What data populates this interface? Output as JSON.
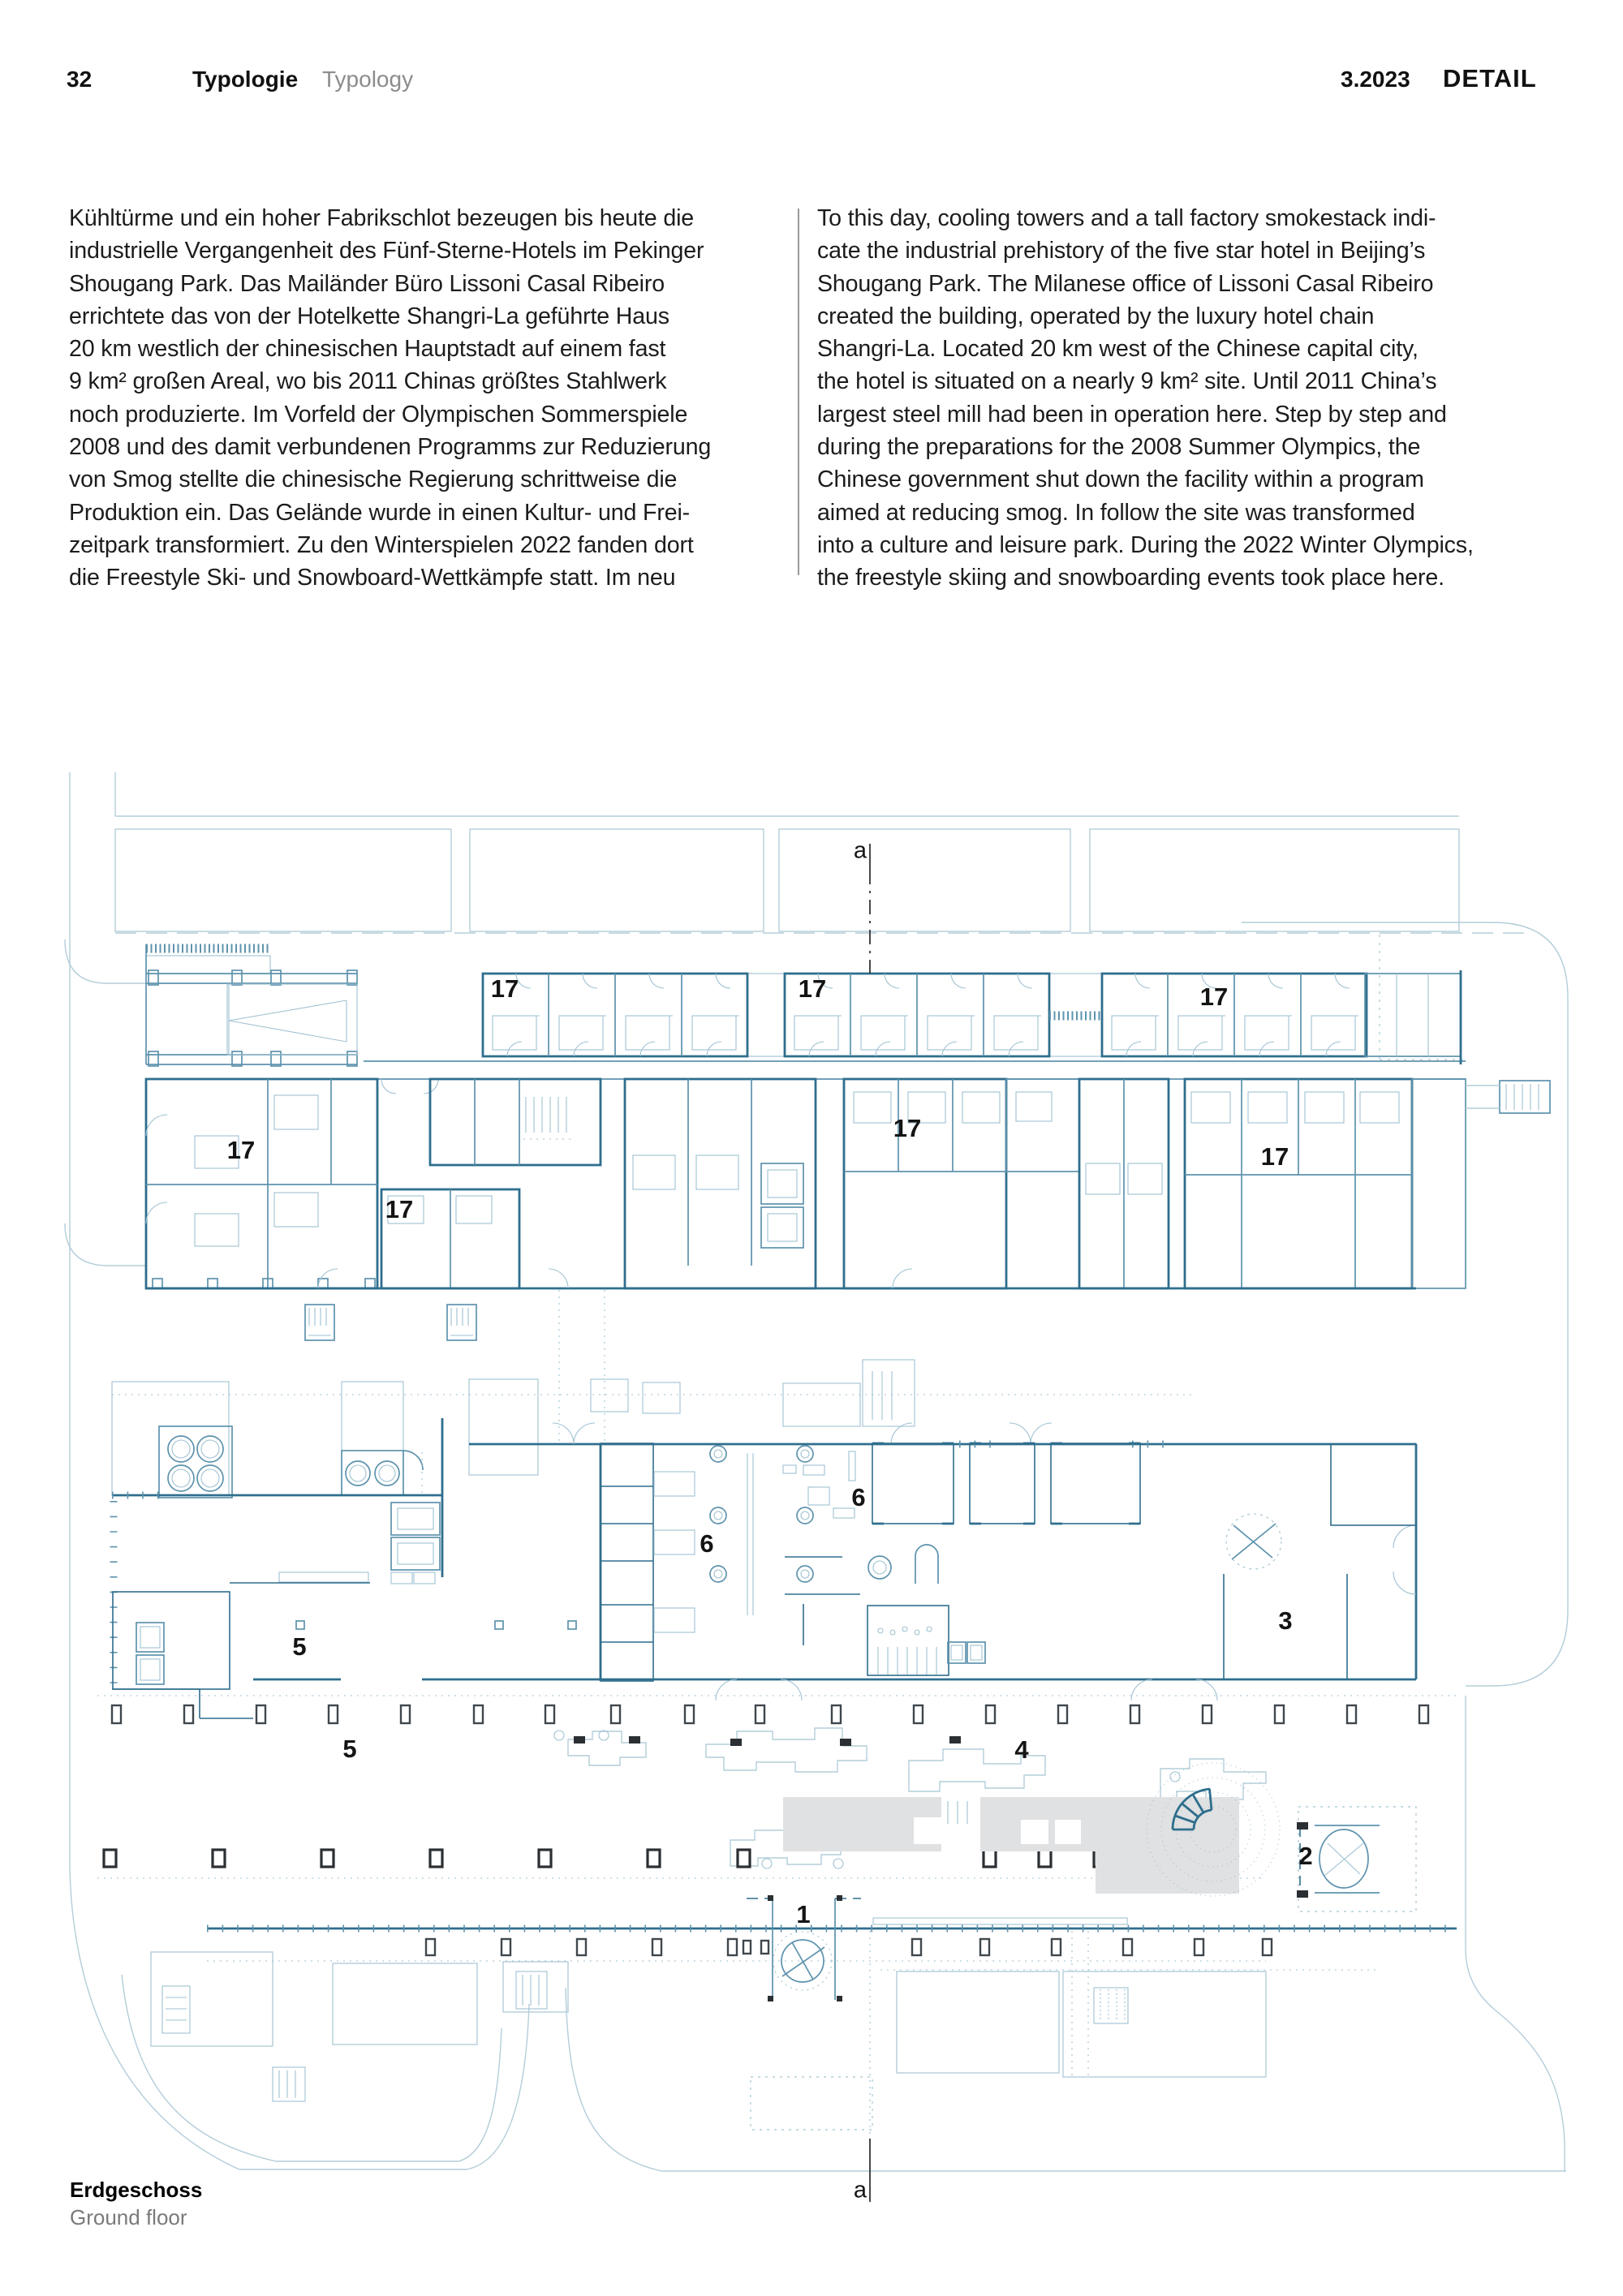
{
  "theme": {
    "context": "#b3cdd9",
    "line-light": "#9fc1d1",
    "line-mid": "#5e93ad",
    "line-dark": "#2f6e8d",
    "column": "#3f474d",
    "paving": "#dfe1e2",
    "label": "#141414",
    "divider": "#9a9a9a",
    "muted": "#8c8c8c",
    "text": "#1c1c1c"
  },
  "header": {
    "page_number": "32",
    "section_de": "Typologie",
    "section_en": "Typology",
    "issue": "3.2023",
    "logo": "DETAIL"
  },
  "article": {
    "de_lines": [
      "Kühltürme und ein hoher Fabrikschlot bezeugen bis heute die",
      "industrielle Vergangenheit des Fünf-Sterne-Hotels im Pekinger",
      "Shougang Park. Das Mailänder Büro Lissoni Casal Ribeiro",
      "errichtete das von der Hotelkette Shangri-La geführte Haus",
      "20 km westlich der chinesischen Hauptstadt auf einem fast",
      "9 km² großen Areal, wo bis 2011 Chinas größtes Stahlwerk",
      "noch produzierte. Im Vorfeld der Olympischen Sommerspiele",
      "2008 und des damit verbundenen Programms zur Reduzierung",
      "von Smog  stellte die chinesische Regierung schrittweise die",
      "Produktion ein. Das Gelände wurde in einen Kultur- und Frei-",
      "zeitpark transformiert. Zu den Winterspielen 2022 fanden dort",
      "die Freestyle Ski- und Snowboard-Wettkämpfe statt. Im neu"
    ],
    "en_lines": [
      "To this day, cooling towers and a tall factory smokestack indi-",
      "cate the industrial prehistory of the five star hotel in Beijing’s",
      "Shougang Park. The Milanese office of Lissoni Casal Ribeiro",
      "created the building, operated by the luxury hotel chain",
      "Shangri-La. Located 20 km west of the Chinese capital city,",
      "the hotel is situated on a nearly 9 km² site. Until 2011 China’s",
      "largest steel mill had been in operation here. Step by step and",
      "during the preparations for the 2008 Summer Olympics, the",
      "Chinese government shut down the facility within a program",
      "aimed at reducing smog. In follow the site was transformed",
      "into a culture and leisure park. During the 2022 Winter Olympics,",
      "the freestyle skiing and snowboarding events took place here."
    ]
  },
  "plan": {
    "caption": {
      "de": "Erdgeschoss",
      "en": "Ground floor"
    },
    "labels": [
      {
        "key": "section-a-top",
        "text": "a"
      },
      {
        "key": "room-17-north-1",
        "text": "17"
      },
      {
        "key": "room-17-north-2",
        "text": "17"
      },
      {
        "key": "room-17-north-3",
        "text": "17"
      },
      {
        "key": "room-17-south-west",
        "text": "17"
      },
      {
        "key": "room-17-south-mid",
        "text": "17"
      },
      {
        "key": "room-17-south-east",
        "text": "17"
      },
      {
        "key": "room-17-suite",
        "text": "17"
      },
      {
        "key": "room-6-east",
        "text": "6"
      },
      {
        "key": "room-6-west",
        "text": "6"
      },
      {
        "key": "room-5-hall",
        "text": "5"
      },
      {
        "key": "room-3",
        "text": "3"
      },
      {
        "key": "room-5-terrace",
        "text": "5"
      },
      {
        "key": "room-4",
        "text": "4"
      },
      {
        "key": "room-2",
        "text": "2"
      },
      {
        "key": "room-1",
        "text": "1"
      },
      {
        "key": "section-a-bottom",
        "text": "a"
      }
    ]
  }
}
